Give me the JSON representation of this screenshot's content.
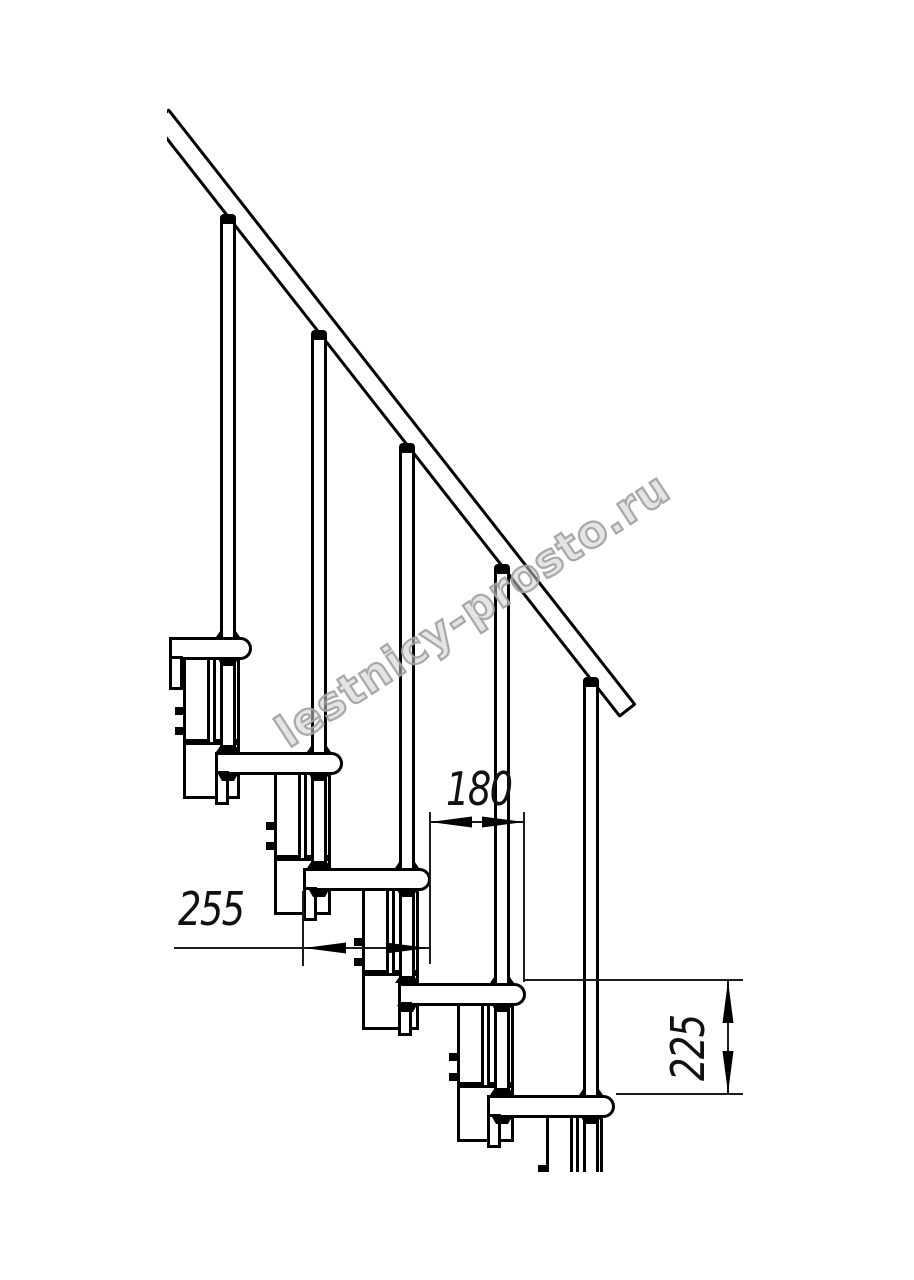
{
  "drawing": {
    "type": "modular-staircase-side-elevation",
    "visible_treads": 5,
    "visible_balusters": 5,
    "has_handrail": true,
    "line_color": "#000000",
    "background_color": "#ffffff"
  },
  "dimensions": {
    "run": {
      "label": "180"
    },
    "tread_depth": {
      "label": "255"
    },
    "rise": {
      "label": "225"
    }
  },
  "watermark": {
    "text": "lestnicy-prosto.ru",
    "color": "#c8c8c8"
  }
}
